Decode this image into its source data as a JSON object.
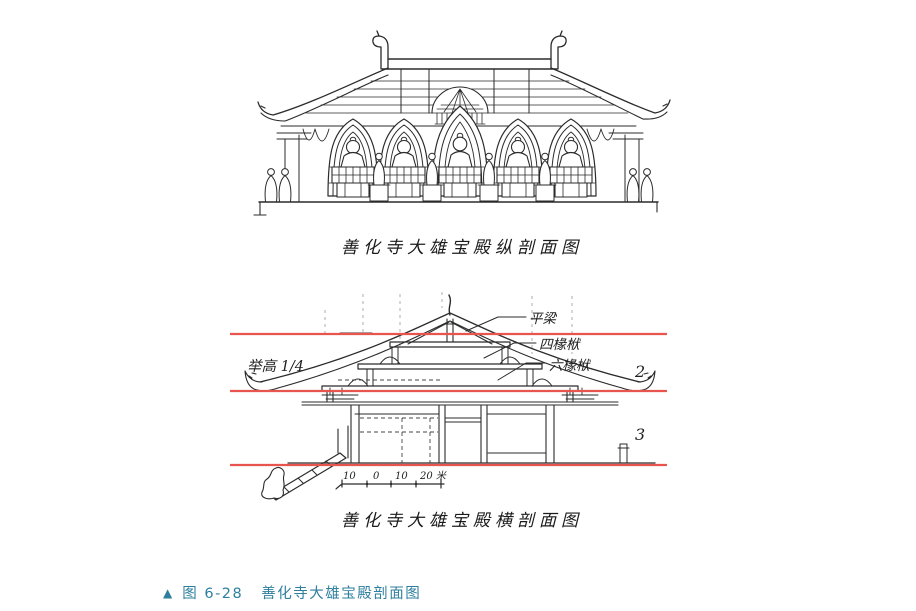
{
  "figure": {
    "marker": "▲",
    "number": "图 6-28",
    "title": "善化寺大雄宝殿剖面图",
    "accent_color": "#2e7f9e"
  },
  "longitudinal": {
    "caption": "善化寺大雄宝殿纵剖面图"
  },
  "transverse": {
    "caption": "善化寺大雄宝殿横剖面图",
    "annotations": {
      "raise_height": "举高 1/4",
      "pingliang": "平梁",
      "sichuanfu": "四椽栿",
      "liuchuanfu": "六椽栿",
      "zone_2": "2",
      "zone_3": "3"
    },
    "scale_bar": {
      "labels": [
        "10",
        "0",
        "10",
        "20 米"
      ]
    },
    "reference_line_color": "#e8554e"
  }
}
